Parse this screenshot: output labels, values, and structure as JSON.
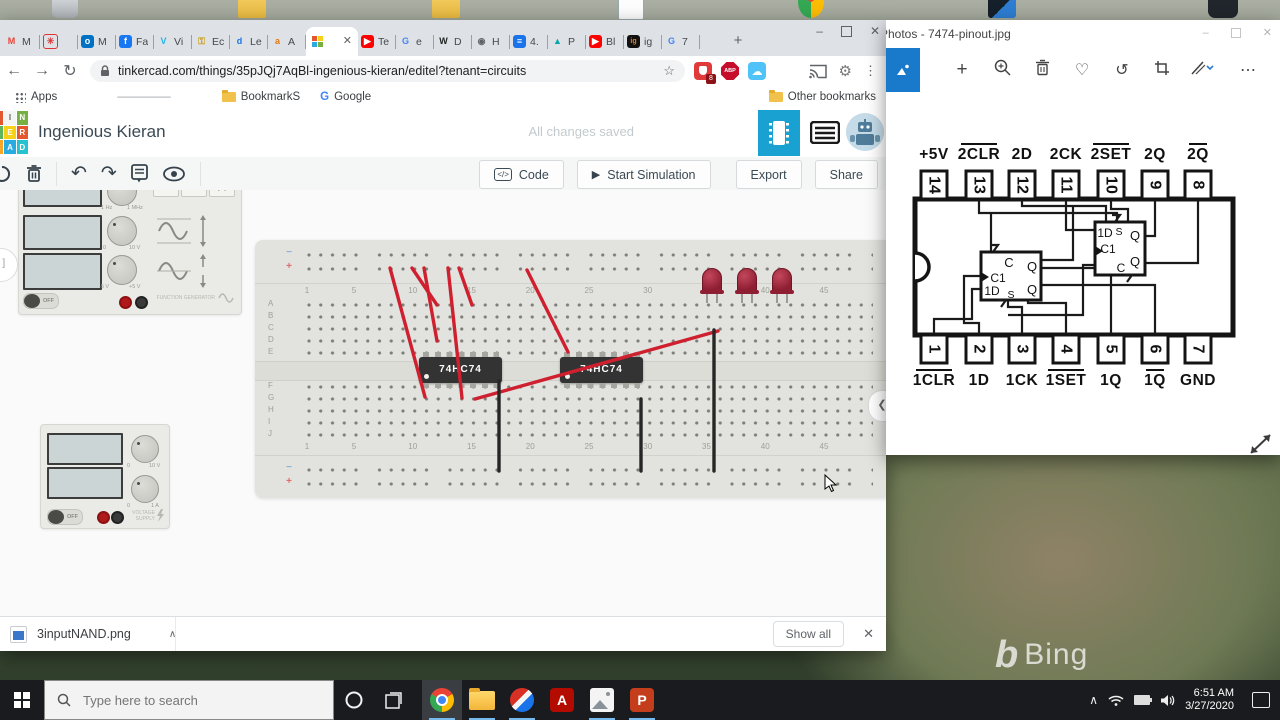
{
  "desktop": {
    "bing_watermark": "Bing",
    "taskbar": {
      "search_placeholder": "Type here to search",
      "clock_time": "6:51 AM",
      "clock_date": "3/27/2020"
    }
  },
  "browser": {
    "tabs": [
      {
        "icon": "gmail",
        "label": "M"
      },
      {
        "icon": "pinwheel",
        "label": ""
      },
      {
        "icon": "outlook",
        "label": "M"
      },
      {
        "icon": "facebook",
        "label": "Fa"
      },
      {
        "icon": "vimeo",
        "label": "Vi"
      },
      {
        "icon": "key",
        "label": "Ec"
      },
      {
        "icon": "dlib",
        "label": "Le"
      },
      {
        "icon": "amazon",
        "label": "A"
      },
      {
        "icon": "tinkercad",
        "label": ""
      },
      {
        "icon": "youtube",
        "label": "Te"
      },
      {
        "icon": "google",
        "label": "e"
      },
      {
        "icon": "wikipedia",
        "label": "D"
      },
      {
        "icon": "globe",
        "label": "H"
      },
      {
        "icon": "docs",
        "label": "4."
      },
      {
        "icon": "autodesk",
        "label": "P"
      },
      {
        "icon": "youtube",
        "label": "Bl"
      },
      {
        "icon": "ig",
        "label": "ig"
      },
      {
        "icon": "google",
        "label": "7"
      }
    ],
    "active_tab_index": 8,
    "new_tab_button": "+",
    "url": "tinkercad.com/things/35pJQj7AqBl-ingenious-kieran/editel?tenant=circuits",
    "extension_badge": "8",
    "extension_abp": "ABP",
    "bookmarks_bar": {
      "apps_label": "Apps",
      "dash_bookmark": "—————",
      "folder_bookmark": "BookmarkS",
      "google_bookmark": "Google",
      "other_label": "Other bookmarks"
    },
    "download_bar": {
      "filename": "3inputNAND.png",
      "show_all_label": "Show all"
    }
  },
  "tinkercad": {
    "logo_letters": [
      "T",
      "I",
      "N",
      "K",
      "E",
      "R",
      "C",
      "A",
      "D"
    ],
    "logo_colors": [
      "#e4572e",
      "#f4f4f2",
      "#76b043",
      "#5bb55f",
      "#f7d117",
      "#e4572e",
      "#f5a623",
      "#29abe2",
      "#27c2cf"
    ],
    "title": "Ingenious Kieran",
    "save_status": "All changes saved",
    "toolbar": {
      "code": "Code",
      "start_simulation": "Start Simulation",
      "export": "Export",
      "share": "Share"
    }
  },
  "breadboard": {
    "rail_minus": "−",
    "rail_plus": "+",
    "column_numbers": [
      1,
      5,
      10,
      15,
      20,
      25,
      30,
      35,
      40,
      45
    ],
    "row_letters_top": [
      "A",
      "B",
      "C",
      "D",
      "E"
    ],
    "row_letters_bottom": [
      "F",
      "G",
      "H",
      "I",
      "J"
    ],
    "chips": [
      {
        "label": "74HC74",
        "x": 164
      },
      {
        "label": "74HC74",
        "x": 305
      }
    ],
    "leds_x": [
      457,
      492,
      527
    ],
    "red_wires": [
      [
        135,
        28,
        170,
        157
      ],
      [
        157,
        28,
        182,
        65
      ],
      [
        169,
        28,
        182,
        101
      ],
      [
        193,
        28,
        207,
        158
      ],
      [
        204,
        28,
        217,
        65
      ],
      [
        272,
        30,
        313,
        112
      ],
      [
        220,
        159,
        463,
        91
      ],
      [
        638,
        28,
        680,
        67
      ]
    ],
    "black_wires": [
      [
        244,
        141,
        244,
        231
      ],
      [
        386,
        159,
        386,
        231
      ],
      [
        459,
        90,
        459,
        231
      ]
    ]
  },
  "instruments": {
    "function_generator": {
      "off_label": "OFF",
      "brand": "FUNCTION GENERATOR",
      "freq_min": "1 Hz",
      "freq_max": "1 MHz",
      "amp_min": "0",
      "amp_max": "10 V",
      "offset_min": "-5 V",
      "offset_max": "+5 V"
    },
    "power_supply": {
      "off_label": "OFF",
      "brand": "VOLTAGE SUPPLY",
      "v_min": "0",
      "v_max": "10 V",
      "a_min": "0",
      "a_max": "1 A"
    }
  },
  "photos_app": {
    "window_title": "Photos - 7474-pinout.jpg",
    "pinout": {
      "top_labels": [
        {
          "text": "+5V",
          "overline": false
        },
        {
          "text": "2CLR",
          "overline": true
        },
        {
          "text": "2D",
          "overline": false
        },
        {
          "text": "2CK",
          "overline": false
        },
        {
          "text": "2SET",
          "overline": true
        },
        {
          "text": "2Q",
          "overline": false
        },
        {
          "text": "2Q",
          "overline": true
        }
      ],
      "top_pin_numbers": [
        "14",
        "13",
        "12",
        "11",
        "10",
        "9",
        "8"
      ],
      "bottom_pin_numbers": [
        "1",
        "2",
        "3",
        "4",
        "5",
        "6",
        "7"
      ],
      "bottom_labels": [
        {
          "text": "1CLR",
          "overline": true
        },
        {
          "text": "1D",
          "overline": false
        },
        {
          "text": "1CK",
          "overline": false
        },
        {
          "text": "1SET",
          "overline": true
        },
        {
          "text": "1Q",
          "overline": false
        },
        {
          "text": "1Q",
          "overline": true
        },
        {
          "text": "GND",
          "overline": false
        }
      ],
      "ff1_labels": [
        "C",
        "Q",
        "C1",
        "1D",
        "S",
        "Q"
      ],
      "ff2_labels": [
        "1D",
        "S",
        "Q",
        "C1",
        "Q",
        "C"
      ]
    }
  }
}
